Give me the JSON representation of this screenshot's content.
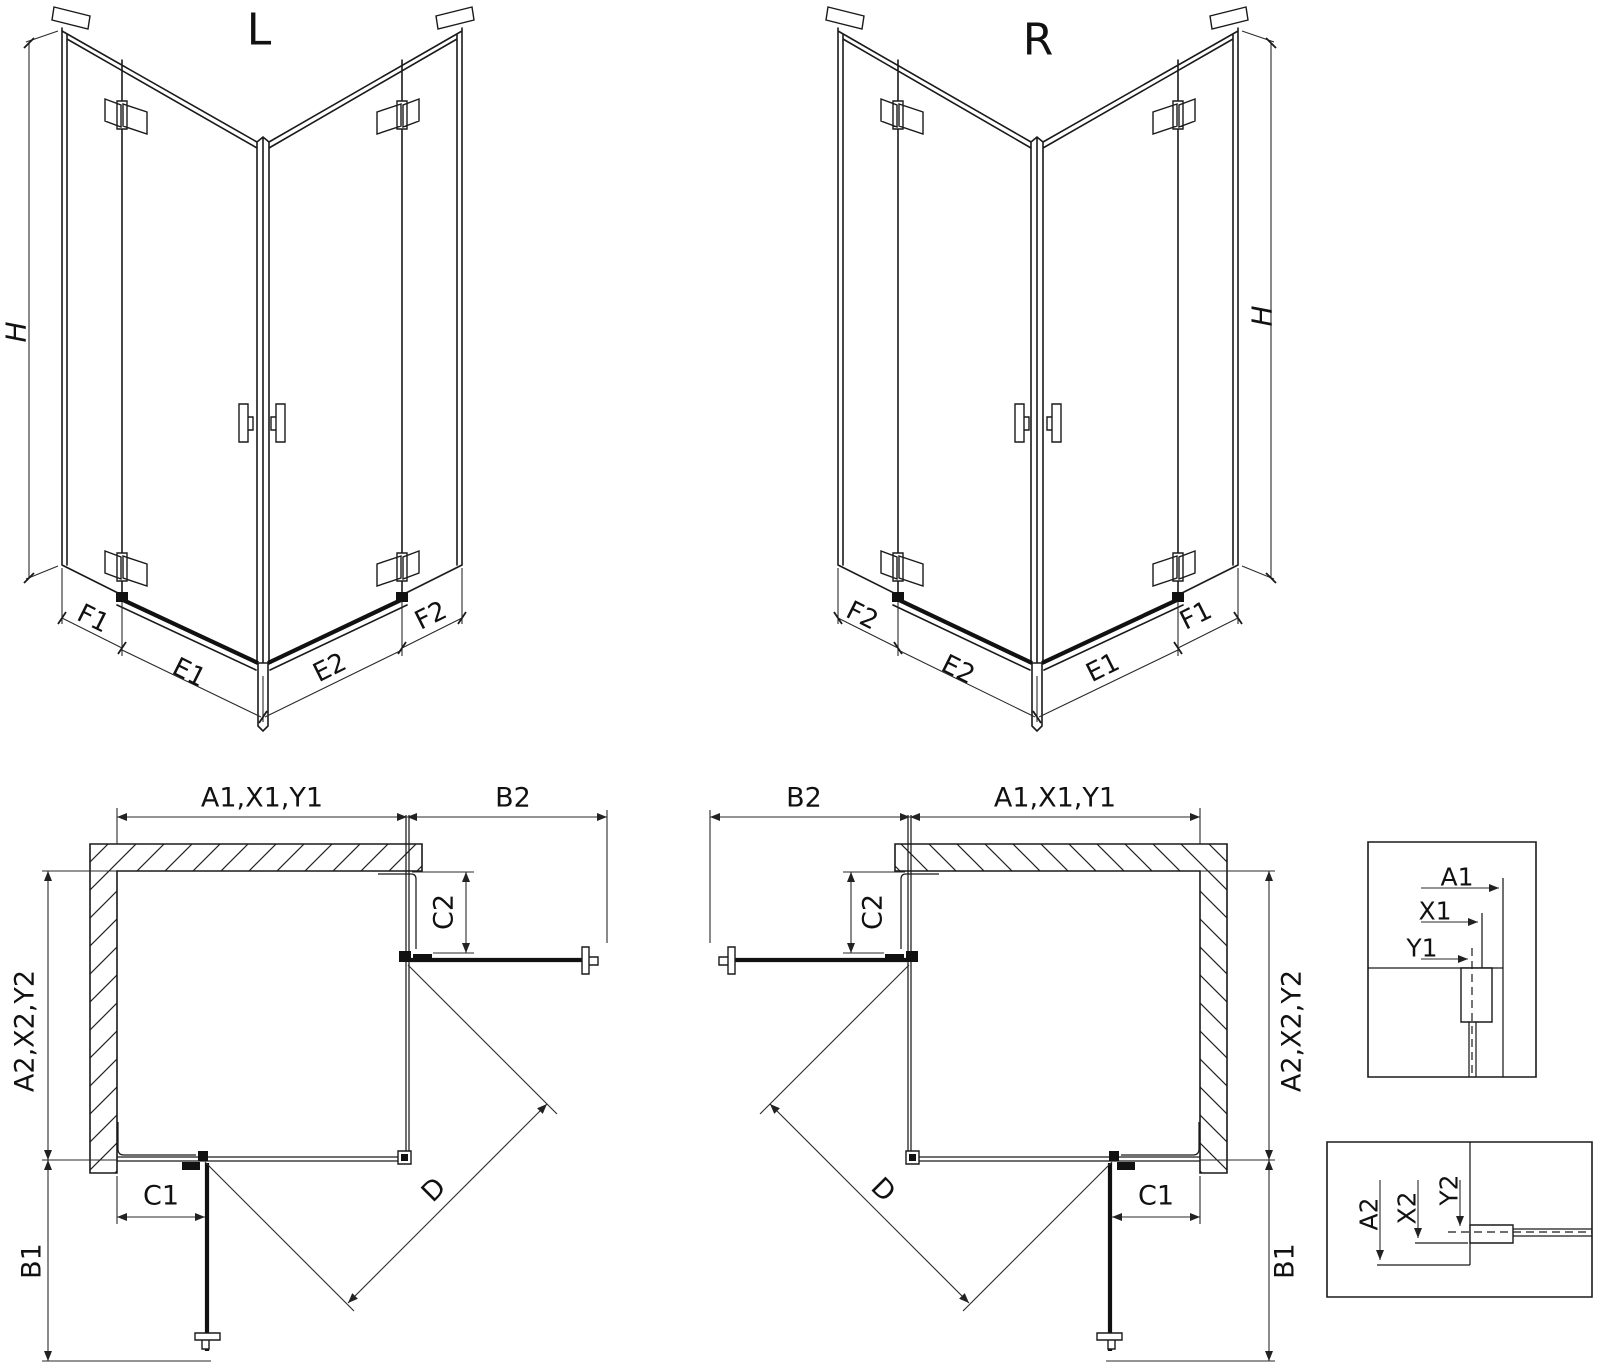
{
  "background": "#ffffff",
  "line_color": "#1a1a1a",
  "iso_left": {
    "title": "L",
    "h": "H",
    "f1": "F1",
    "e1": "E1",
    "e2": "E2",
    "f2": "F2"
  },
  "iso_right": {
    "title": "R",
    "h": "H",
    "f2": "F2",
    "e2": "E2",
    "e1": "E1",
    "f1": "F1"
  },
  "plan_left": {
    "a1": "A1,X1,Y1",
    "b2": "B2",
    "a2": "A2,X2,Y2",
    "c2": "C2",
    "c1": "C1",
    "b1": "B1",
    "d": "D"
  },
  "plan_right": {
    "b2": "B2",
    "a1": "A1,X1,Y1",
    "c2": "C2",
    "a2": "A2,X2,Y2",
    "c1": "C1",
    "b1": "B1",
    "d": "D"
  },
  "detail_top": {
    "a1": "A1",
    "x1": "X1",
    "y1": "Y1"
  },
  "detail_bottom": {
    "a2": "A2",
    "x2": "X2",
    "y2": "Y2"
  }
}
